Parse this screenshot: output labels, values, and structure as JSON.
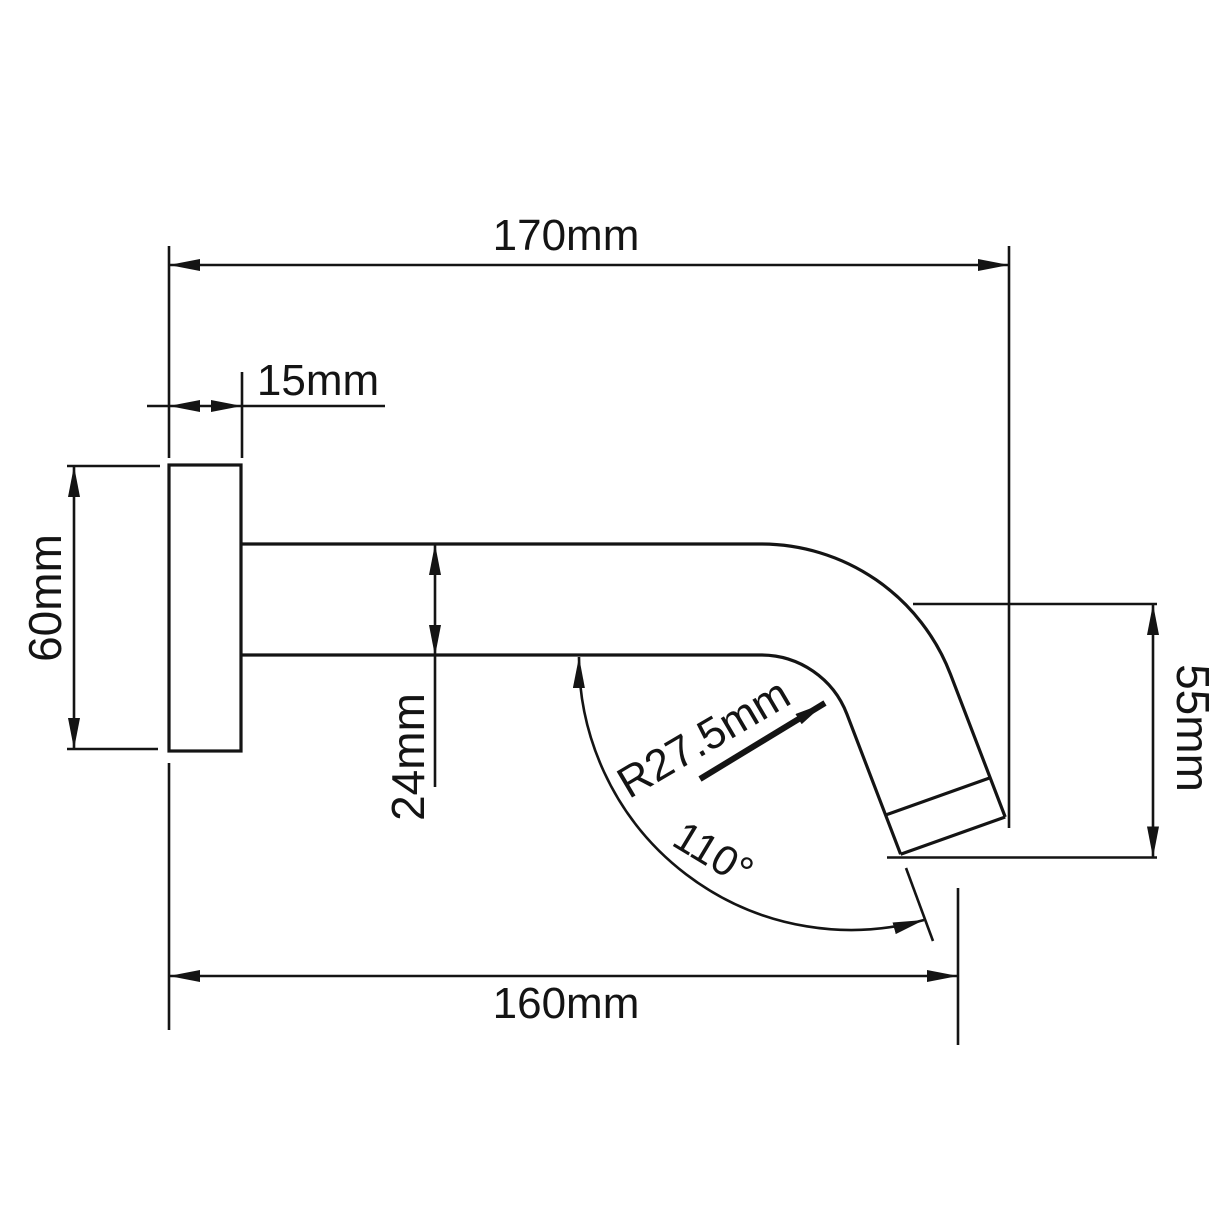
{
  "style": {
    "line_color": "#141414",
    "background": "#ffffff"
  },
  "drawing": {
    "labels": {
      "top_width": "170mm",
      "flange_depth": "15mm",
      "flange_diameter": "60mm",
      "pipe_diameter": "24mm",
      "outlet_drop": "55mm",
      "bottom_reach": "160mm",
      "bend_radius": "R27.5mm",
      "outlet_angle": "110°"
    }
  }
}
